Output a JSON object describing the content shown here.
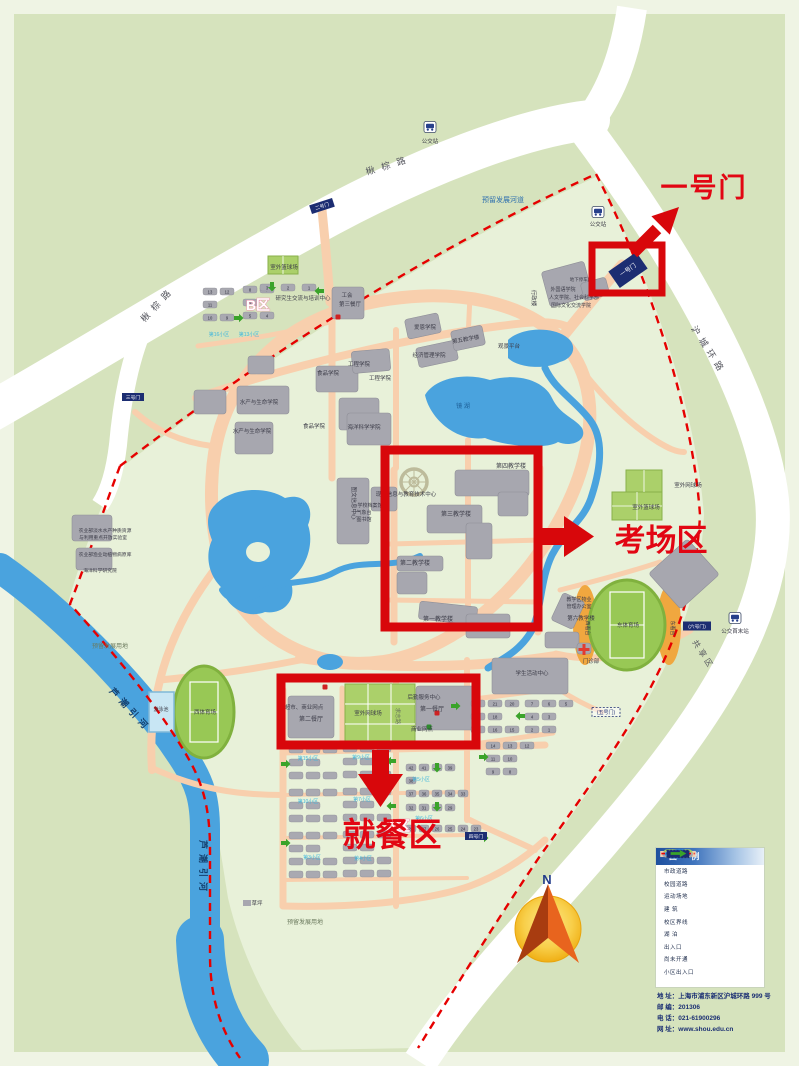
{
  "annotations": {
    "gate": "一号门",
    "exam": "考场区",
    "dining": "就餐区"
  },
  "compass": {
    "north": "N"
  },
  "legend": {
    "title": "图 例",
    "items": [
      {
        "type": "road-municipal",
        "label": "市政道路"
      },
      {
        "type": "road-campus",
        "label": "校园道路"
      },
      {
        "type": "sports",
        "label": "运动场地"
      },
      {
        "type": "building",
        "label": "建 筑"
      },
      {
        "type": "boundary",
        "label": "校区界线"
      },
      {
        "type": "lake",
        "label": "湖 泊"
      },
      {
        "type": "entrance",
        "label": "出入口"
      },
      {
        "type": "not-open",
        "label": "尚未开通"
      },
      {
        "type": "community-entrance",
        "label": "小区出入口"
      }
    ]
  },
  "contact": {
    "lines": [
      "地 址：上海市浦东新区沪城环路 999 号",
      "邮 编：201306",
      "电 话：021-61900296",
      "网 址：www.shou.edu.cn"
    ]
  },
  "colors": {
    "annotation_red": "#d8070b",
    "boundary_red": "#e60000",
    "water_blue": "#4aa3de",
    "campus_road_peach": "#f8cfad",
    "building_gray": "#a7a7af",
    "field_green": "#98c855",
    "gate_navy": "#1c2d72",
    "campus_green": "#e8f1d9",
    "outer_green": "#d6e3bd"
  },
  "map": {
    "labels": [
      {
        "t": "楸棕路",
        "x": 390,
        "y": 168,
        "s": 9,
        "r": -17,
        "c": "roadname",
        "sp": 7
      },
      {
        "t": "楸棕路",
        "x": 160,
        "y": 306,
        "s": 9,
        "r": -47,
        "c": "roadname",
        "sp": 6
      },
      {
        "t": "沪城环路",
        "x": 706,
        "y": 352,
        "s": 9,
        "r": 57,
        "c": "roadname",
        "sp": 5
      },
      {
        "t": "共享区",
        "x": 701,
        "y": 656,
        "s": 8,
        "r": 57,
        "c": "roadname",
        "sp": 3
      },
      {
        "t": "芦潮引河",
        "x": 128,
        "y": 712,
        "s": 9,
        "r": 47,
        "c": "rivername",
        "sp": 5
      },
      {
        "t": "芦潮引河",
        "x": 200,
        "y": 868,
        "s": 9,
        "r": 90,
        "c": "rivername",
        "sp": 5
      },
      {
        "t": "预留发展河道",
        "x": 503,
        "y": 202,
        "s": 7,
        "c": "bluetxt"
      },
      {
        "t": "预留发展用地",
        "x": 110,
        "y": 648,
        "s": 6,
        "c": "dim"
      },
      {
        "t": "预留发展用地",
        "x": 305,
        "y": 924,
        "s": 6,
        "c": "dim"
      },
      {
        "t": "公交站",
        "x": 430,
        "y": 143,
        "s": 5.5
      },
      {
        "t": "公交站",
        "x": 598,
        "y": 226,
        "s": 5.5
      },
      {
        "t": "公交首末站",
        "x": 735,
        "y": 633,
        "s": 5.5
      },
      {
        "t": "B区",
        "x": 258,
        "y": 310,
        "s": 14,
        "c": "zone"
      },
      {
        "t": "A区",
        "x": 398,
        "y": 831,
        "s": 14,
        "c": "zone"
      },
      {
        "t": "研究生交流与培训中心",
        "x": 303,
        "y": 300,
        "s": 5.5
      },
      {
        "t": "工会",
        "x": 347,
        "y": 297,
        "s": 5.5
      },
      {
        "t": "第三餐厅",
        "x": 350,
        "y": 306,
        "s": 5.5
      },
      {
        "t": "室外篮球场",
        "x": 284,
        "y": 269,
        "s": 5.5
      },
      {
        "t": "室外网球场",
        "x": 688,
        "y": 487,
        "s": 5.5
      },
      {
        "t": "室外篮球场",
        "x": 646,
        "y": 509,
        "s": 5.5
      },
      {
        "t": "西体育场",
        "x": 205,
        "y": 714,
        "s": 5.5
      },
      {
        "t": "游泳池",
        "x": 161,
        "y": 711,
        "s": 5
      },
      {
        "t": "东体育场",
        "x": 628,
        "y": 627,
        "s": 5.5
      },
      {
        "t": "西看台",
        "x": 586,
        "y": 628,
        "s": 5,
        "r": 90
      },
      {
        "t": "东看台",
        "x": 671,
        "y": 628,
        "s": 5,
        "r": 90
      },
      {
        "t": "门诊部",
        "x": 591,
        "y": 663,
        "s": 5.5
      },
      {
        "t": "学生活动中心",
        "x": 532,
        "y": 675,
        "s": 5.5
      },
      {
        "t": "第一教学楼",
        "x": 438,
        "y": 621,
        "s": 6
      },
      {
        "t": "第二教学楼",
        "x": 415,
        "y": 565,
        "s": 6
      },
      {
        "t": "第三教学楼",
        "x": 456,
        "y": 516,
        "s": 6
      },
      {
        "t": "第四教学楼",
        "x": 511,
        "y": 468,
        "s": 6
      },
      {
        "t": "第五教学楼",
        "x": 466,
        "y": 341,
        "s": 5.5,
        "r": -10
      },
      {
        "t": "第六教学楼",
        "x": 581,
        "y": 620,
        "s": 5.5
      },
      {
        "t": "教学区物业",
        "x": 579,
        "y": 601,
        "s": 5
      },
      {
        "t": "管理办公室",
        "x": 579,
        "y": 608,
        "s": 5
      },
      {
        "t": "经济管理学院",
        "x": 429,
        "y": 357,
        "s": 5.5
      },
      {
        "t": "爱恩学院",
        "x": 425,
        "y": 329,
        "s": 5.5
      },
      {
        "t": "工程学院",
        "x": 359,
        "y": 366,
        "s": 5.5
      },
      {
        "t": "工程学院",
        "x": 380,
        "y": 380,
        "s": 5.5
      },
      {
        "t": "海洋科学学院",
        "x": 364,
        "y": 429,
        "s": 5.5
      },
      {
        "t": "食品学院",
        "x": 328,
        "y": 375,
        "s": 5.5
      },
      {
        "t": "食品学院",
        "x": 314,
        "y": 428,
        "s": 5.5
      },
      {
        "t": "水产与生命学院",
        "x": 259,
        "y": 404,
        "s": 5.5
      },
      {
        "t": "水产与生命学院",
        "x": 252,
        "y": 433,
        "s": 5.5
      },
      {
        "t": "图文信息中心",
        "x": 352,
        "y": 503,
        "s": 5.5,
        "r": 90
      },
      {
        "t": "现代信息与教育技术中心",
        "x": 406,
        "y": 496,
        "s": 5.5
      },
      {
        "t": "学校档案馆",
        "x": 370,
        "y": 507,
        "s": 5
      },
      {
        "t": "气象台",
        "x": 364,
        "y": 514,
        "s": 5
      },
      {
        "t": "图书馆",
        "x": 364,
        "y": 521,
        "s": 5
      },
      {
        "t": "行政楼",
        "x": 532,
        "y": 298,
        "s": 5.5,
        "r": 90
      },
      {
        "t": "外国语学院",
        "x": 563,
        "y": 291,
        "s": 5
      },
      {
        "t": "人文学院、社会科学部",
        "x": 574,
        "y": 299,
        "s": 5
      },
      {
        "t": "国际文化交流学院",
        "x": 571,
        "y": 307,
        "s": 5
      },
      {
        "t": "地下停车库",
        "x": 581,
        "y": 281,
        "s": 4.5
      },
      {
        "t": "观景平台",
        "x": 509,
        "y": 348,
        "s": 5.5
      },
      {
        "t": "第一餐厅",
        "x": 432,
        "y": 711,
        "s": 6
      },
      {
        "t": "后勤服务中心",
        "x": 424,
        "y": 699,
        "s": 5.5
      },
      {
        "t": "商业网点",
        "x": 422,
        "y": 731,
        "s": 5.5
      },
      {
        "t": "第二餐厅",
        "x": 311,
        "y": 721,
        "s": 6
      },
      {
        "t": "超市、商业网点",
        "x": 304,
        "y": 709,
        "s": 5.5
      },
      {
        "t": "室外网球场",
        "x": 368,
        "y": 715,
        "s": 5.5
      },
      {
        "t": "求志路",
        "x": 396,
        "y": 716,
        "s": 5.5,
        "r": 90,
        "c": "dim"
      },
      {
        "t": "镜 湖",
        "x": 463,
        "y": 408,
        "s": 6,
        "c": "laketxt"
      },
      {
        "t": "草坪",
        "x": 257,
        "y": 905,
        "s": 5.5
      },
      {
        "t": "农业部淡水水产种质资源",
        "x": 105,
        "y": 532,
        "s": 4.8
      },
      {
        "t": "与利用重点开放实验室",
        "x": 103,
        "y": 539,
        "s": 4.8
      },
      {
        "t": "农业部渔业动植物病原库",
        "x": 105,
        "y": 556,
        "s": 4.8
      },
      {
        "t": "海洋科学研究院",
        "x": 100,
        "y": 572,
        "s": 4.8
      },
      {
        "t": "第15小区",
        "x": 308,
        "y": 760,
        "s": 5,
        "c": "cyan"
      },
      {
        "t": "第9小区",
        "x": 361,
        "y": 759,
        "s": 5,
        "c": "cyan"
      },
      {
        "t": "第10小区",
        "x": 308,
        "y": 803,
        "s": 5,
        "c": "cyan"
      },
      {
        "t": "第7小区",
        "x": 362,
        "y": 801,
        "s": 5,
        "c": "cyan"
      },
      {
        "t": "第5小区",
        "x": 421,
        "y": 781,
        "s": 5,
        "c": "cyan"
      },
      {
        "t": "第6小区",
        "x": 424,
        "y": 820,
        "s": 5,
        "c": "cyan"
      },
      {
        "t": "第3小区",
        "x": 312,
        "y": 859,
        "s": 5,
        "c": "cyan"
      },
      {
        "t": "第4小区",
        "x": 363,
        "y": 860,
        "s": 5,
        "c": "cyan"
      },
      {
        "t": "第16小区",
        "x": 219,
        "y": 336,
        "s": 5,
        "c": "cyan"
      },
      {
        "t": "第13小区",
        "x": 249,
        "y": 336,
        "s": 5,
        "c": "cyan"
      }
    ],
    "buildings": [
      [
        545,
        266,
        44,
        36,
        -15
      ],
      [
        582,
        280,
        26,
        18,
        -15
      ],
      [
        455,
        470,
        74,
        26,
        0
      ],
      [
        498,
        492,
        30,
        24,
        0
      ],
      [
        427,
        505,
        55,
        28,
        0
      ],
      [
        466,
        523,
        26,
        36,
        0
      ],
      [
        397,
        556,
        46,
        15,
        0
      ],
      [
        397,
        572,
        30,
        22,
        0
      ],
      [
        419,
        604,
        58,
        18,
        6
      ],
      [
        466,
        614,
        44,
        24,
        0
      ],
      [
        337,
        478,
        32,
        66,
        0
      ],
      [
        371,
        487,
        26,
        24,
        0
      ],
      [
        237,
        386,
        52,
        28,
        0
      ],
      [
        235,
        422,
        38,
        32,
        0
      ],
      [
        316,
        366,
        42,
        26,
        0
      ],
      [
        339,
        398,
        40,
        32,
        0
      ],
      [
        352,
        350,
        38,
        22,
        -5
      ],
      [
        347,
        413,
        44,
        32,
        0
      ],
      [
        417,
        344,
        40,
        20,
        -12
      ],
      [
        406,
        316,
        34,
        20,
        -12
      ],
      [
        452,
        328,
        32,
        20,
        -12
      ],
      [
        332,
        287,
        32,
        32,
        0
      ],
      [
        492,
        658,
        76,
        36,
        0
      ],
      [
        545,
        632,
        34,
        16,
        0
      ],
      [
        556,
        596,
        24,
        30,
        25
      ],
      [
        658,
        550,
        52,
        48,
        -42
      ],
      [
        416,
        686,
        62,
        44,
        0
      ],
      [
        288,
        696,
        46,
        42,
        0
      ],
      [
        577,
        643,
        14,
        11,
        0
      ],
      [
        194,
        390,
        32,
        24,
        0
      ],
      [
        72,
        515,
        40,
        26,
        0
      ],
      [
        76,
        548,
        36,
        22,
        0
      ],
      [
        248,
        356,
        26,
        18,
        0
      ]
    ],
    "dorm_clusters": [
      {
        "x": 289,
        "y": 746,
        "rows": [
          [
            "",
            "",
            ""
          ],
          [
            "",
            ""
          ],
          [
            "",
            "",
            ""
          ]
        ]
      },
      {
        "x": 343,
        "y": 745,
        "rows": [
          [
            "",
            "",
            ""
          ],
          [
            "",
            ""
          ],
          [
            "",
            "",
            ""
          ]
        ]
      },
      {
        "x": 289,
        "y": 789,
        "rows": [
          [
            "",
            "",
            ""
          ],
          [
            "",
            ""
          ],
          [
            "",
            "",
            ""
          ]
        ]
      },
      {
        "x": 343,
        "y": 788,
        "rows": [
          [
            "",
            "",
            ""
          ],
          [
            "",
            ""
          ],
          [
            "",
            "",
            ""
          ]
        ]
      },
      {
        "x": 289,
        "y": 832,
        "rows": [
          [
            "",
            "",
            ""
          ],
          [
            "",
            ""
          ],
          [
            "",
            "",
            ""
          ],
          [
            "",
            "",
            ""
          ]
        ]
      },
      {
        "x": 343,
        "y": 831,
        "rows": [
          [
            "",
            "",
            ""
          ],
          [
            "",
            ""
          ],
          [
            "",
            "",
            ""
          ],
          [
            "",
            "",
            ""
          ]
        ]
      },
      {
        "x": 406,
        "y": 764,
        "pw": 13,
        "bw": 10,
        "rows": [
          [
            "42",
            "41",
            "40",
            "39"
          ],
          [
            "38"
          ],
          [
            "37",
            "36",
            "35",
            "34",
            "33"
          ]
        ]
      },
      {
        "x": 406,
        "y": 804,
        "pw": 13,
        "bw": 10,
        "dys": [
          0,
          21
        ],
        "rows": [
          [
            "32",
            "31",
            "30",
            "29"
          ],
          [
            "28",
            "27",
            "26",
            "25",
            "24",
            "23"
          ]
        ]
      },
      {
        "x": 471,
        "y": 700,
        "rows": [
          [
            "22",
            "21",
            "20"
          ],
          [
            "19",
            "18"
          ],
          [
            "17",
            "16",
            "15"
          ]
        ]
      },
      {
        "x": 525,
        "y": 700,
        "rows": [
          [
            "7",
            "6",
            "5"
          ],
          [
            "4",
            "3"
          ],
          [
            "2",
            "1"
          ]
        ]
      },
      {
        "x": 486,
        "y": 742,
        "rows": [
          [
            "14",
            "13",
            "12"
          ],
          [
            "11",
            "10"
          ],
          [
            "9",
            "8"
          ]
        ]
      },
      {
        "x": 203,
        "y": 288,
        "rows": [
          [
            "13",
            "12"
          ],
          [
            "11"
          ],
          [
            "10",
            "9"
          ]
        ]
      },
      {
        "x": 243,
        "y": 286,
        "rows": [
          [
            "8",
            "7"
          ],
          [
            "6"
          ],
          [
            "5",
            "4"
          ]
        ]
      },
      {
        "x": 260,
        "y": 284,
        "pw": 21,
        "rows": [
          [
            "3",
            "2",
            "1"
          ]
        ]
      }
    ],
    "gates": [
      {
        "t": "一号门",
        "x": 628,
        "y": 270,
        "r": -35,
        "style": "solid",
        "w": 34,
        "h": 20,
        "fs": 6
      },
      {
        "t": "二号门",
        "x": 322,
        "y": 206,
        "r": -18,
        "style": "solid",
        "w": 24,
        "h": 9,
        "fs": 4.8
      },
      {
        "t": "三号门",
        "x": 133,
        "y": 397,
        "r": 0,
        "style": "solid",
        "w": 22,
        "h": 8,
        "fs": 4.8
      },
      {
        "t": "四号门",
        "x": 476,
        "y": 836,
        "r": 0,
        "style": "solid",
        "w": 22,
        "h": 8,
        "fs": 4.8
      },
      {
        "t": "(五号门)",
        "x": 606,
        "y": 712,
        "r": 0,
        "style": "dashed",
        "w": 28,
        "h": 9,
        "fs": 5
      },
      {
        "t": "(六号门)",
        "x": 697,
        "y": 626,
        "r": 0,
        "style": "solid",
        "w": 28,
        "h": 9,
        "fs": 4.8
      }
    ],
    "bus_stops": [
      [
        430,
        127
      ],
      [
        598,
        212
      ],
      [
        735,
        618
      ]
    ],
    "green_arrows": [
      [
        285,
        764,
        "r"
      ],
      [
        392,
        761,
        "l"
      ],
      [
        437,
        767,
        "d"
      ],
      [
        483,
        757,
        "r"
      ],
      [
        285,
        843,
        "r"
      ],
      [
        392,
        806,
        "l"
      ],
      [
        437,
        806,
        "d"
      ],
      [
        483,
        838,
        "r"
      ],
      [
        272,
        286,
        "d"
      ],
      [
        320,
        291,
        "l"
      ],
      [
        238,
        318,
        "r"
      ],
      [
        455,
        706,
        "r"
      ],
      [
        521,
        716,
        "l"
      ]
    ],
    "poi": [
      [
        325,
        687,
        "r"
      ],
      [
        437,
        713,
        "r"
      ],
      [
        429,
        727,
        "g"
      ],
      [
        338,
        317,
        "r"
      ]
    ]
  }
}
